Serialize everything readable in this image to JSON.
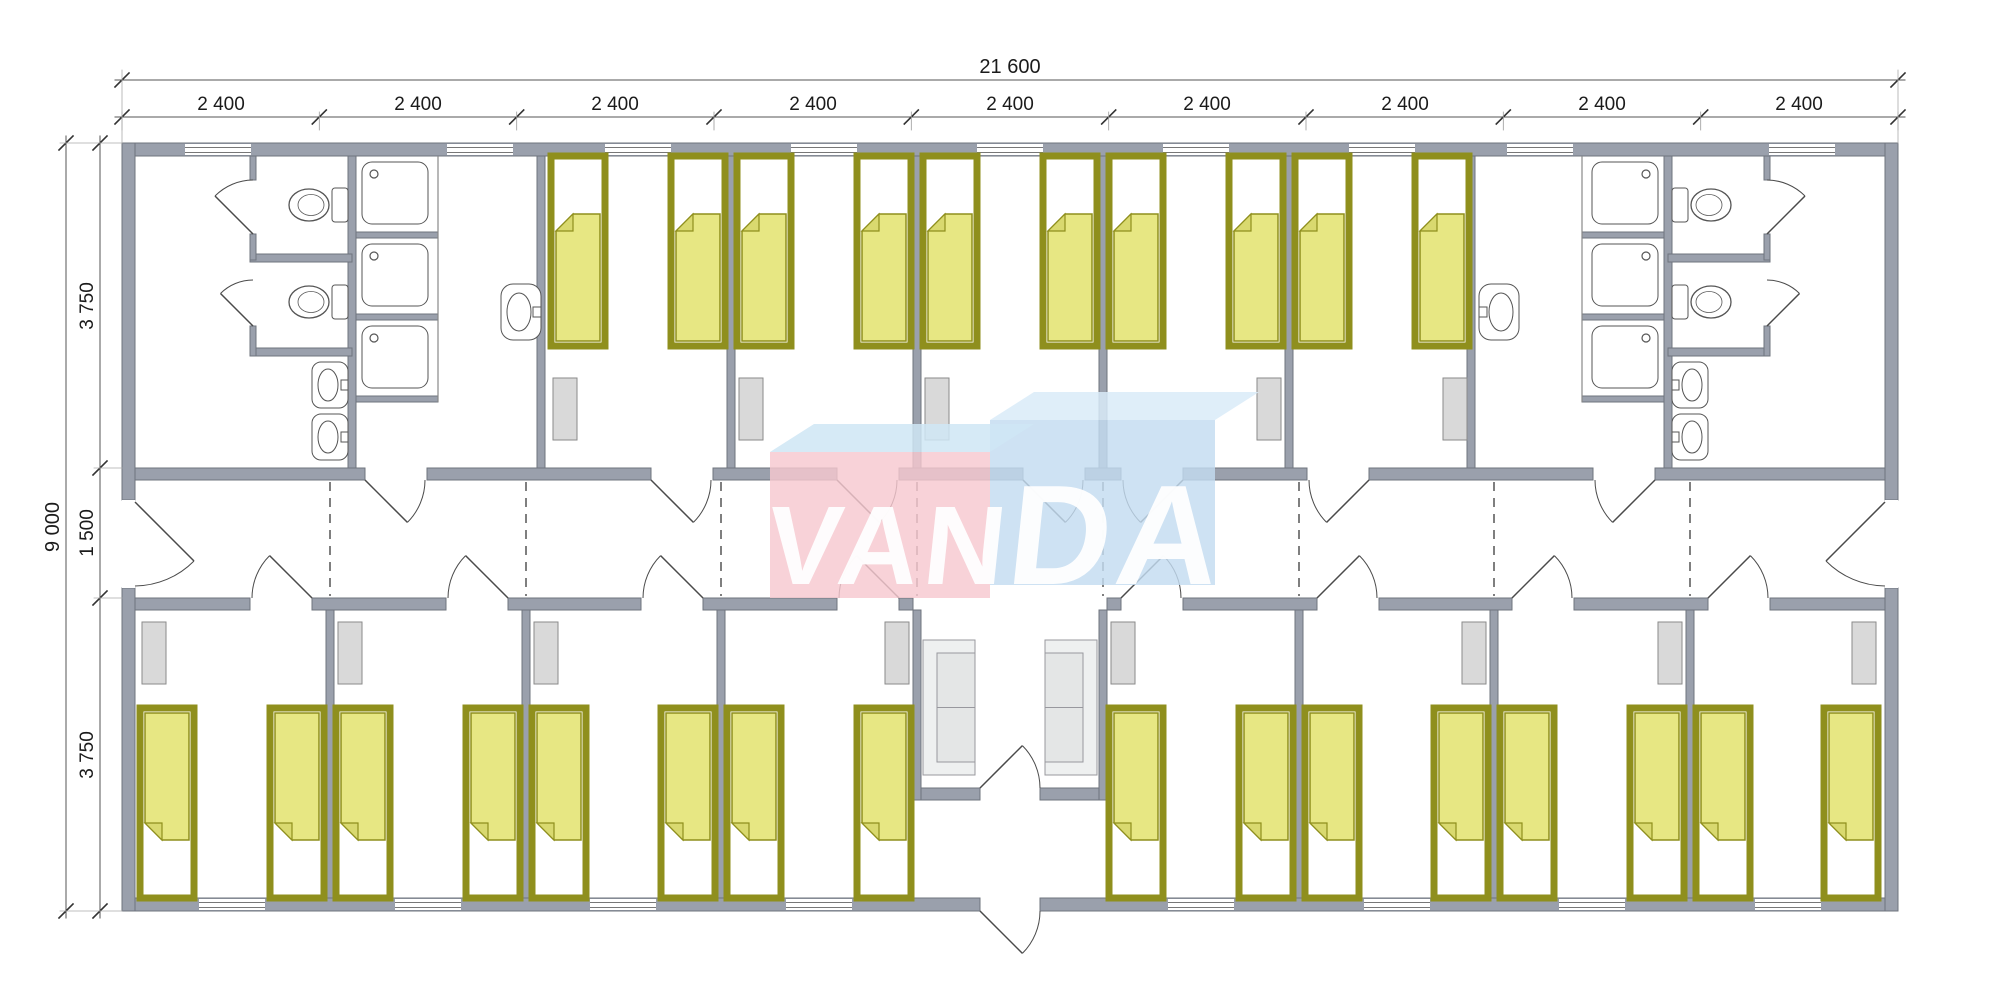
{
  "watermark": {
    "text": "VANDA",
    "left": "VAN",
    "right": "DA",
    "pink_face": "#f6c8cf",
    "pink_top_face": "#cfe6f4",
    "blue_face": "#c3dcf0",
    "blue_top_face": "#d9ebf8",
    "letter_color": "#ffffff"
  },
  "dimensions": {
    "total_width": "21 600",
    "modules": [
      "2 400",
      "2 400",
      "2 400",
      "2 400",
      "2 400",
      "2 400",
      "2 400",
      "2 400",
      "2 400"
    ],
    "total_height": "9 000",
    "vertical_segments": [
      "3 750",
      "1 500",
      "3 750"
    ]
  },
  "colors": {
    "wall": "#9aa0ac",
    "wall_edge": "#6f747e",
    "bed_frame": "#8f8f1d",
    "bed_blanket": "#e7e783",
    "bed_fold": "#d9d96f",
    "wardrobe": "#d9d9d9",
    "wardrobe_edge": "#8a8a8a",
    "sofa": "#eef0f0",
    "sofa_seat": "#e4e6e6",
    "sofa_edge": "#98989e",
    "fixture_line": "#555555",
    "door_line": "#4a4a4a",
    "dash": "#555555",
    "dim_line": "#555555",
    "window_line": "#777777",
    "background": "#ffffff"
  },
  "plan": {
    "building": {
      "modules": 9,
      "module_mm": 2400,
      "width_mm": 21600,
      "depth_mm": 9000,
      "corridor_mm": 1500,
      "room_depth_mm": 3750
    },
    "top_row": {
      "washrooms": 2,
      "bedrooms": 5,
      "beds_per_room": 2,
      "washroom_fixtures": {
        "wc_stalls": 2,
        "toilets": 2,
        "showers": 3,
        "wash_basins": 2,
        "sinks": 1
      }
    },
    "bottom_row": {
      "bedrooms": 8,
      "beds_per_room": 2,
      "vestibule": {
        "sofas": 2,
        "inner_door": 1,
        "entry_door": 1
      }
    },
    "corridor": {
      "end_doors": 2,
      "room_doors": 15,
      "module_joint_lines": 8
    },
    "furniture_totals": {
      "beds": 26,
      "wardrobes": 13,
      "sofas": 2
    }
  }
}
